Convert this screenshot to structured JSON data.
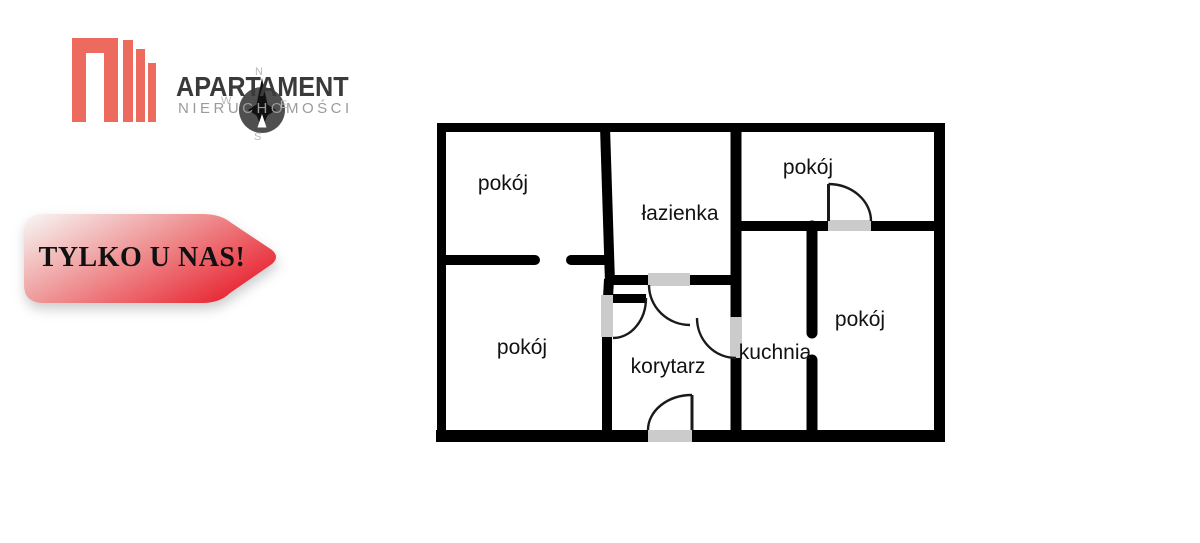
{
  "logo": {
    "title": "APARTAMENT",
    "subtitle": "NIERUCHOMOŚCI",
    "brand_color": "#ed6a5f",
    "title_color": "#3a3a3a",
    "subtitle_color": "#9b9b9b",
    "compass": {
      "n": "N",
      "e": "E",
      "s": "S",
      "w": "W"
    }
  },
  "banner": {
    "label": "TYLKO U NAS!",
    "gradient_start": "#f6efed",
    "gradient_mid": "#ee8a8c",
    "gradient_end": "#e8202e"
  },
  "floor_plan": {
    "wall_color": "#000000",
    "door_sill_color": "#cbcbcb",
    "rooms": [
      {
        "id": "room-top-left",
        "label": "pokój"
      },
      {
        "id": "bathroom",
        "label": "łazienka"
      },
      {
        "id": "room-top-right",
        "label": "pokój"
      },
      {
        "id": "room-bottom-left",
        "label": "pokój"
      },
      {
        "id": "hallway",
        "label": "korytarz"
      },
      {
        "id": "kitchen",
        "label": "kuchnia"
      },
      {
        "id": "room-right",
        "label": "pokój"
      }
    ]
  }
}
